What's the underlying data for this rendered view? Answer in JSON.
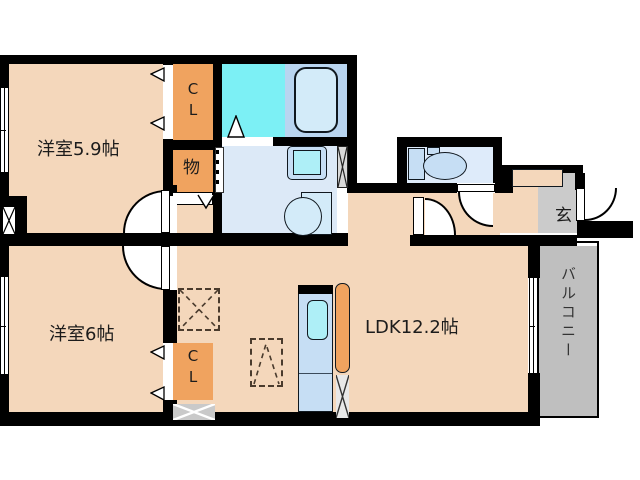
{
  "plan": {
    "title": "apartment floor plan",
    "rooms": {
      "bedroom1": {
        "label": "洋室5.9帖"
      },
      "bedroom2": {
        "label": "洋室6帖"
      },
      "ldk": {
        "label": "LDK12.2帖"
      },
      "closet_top": {
        "label": "C\nL"
      },
      "closet_bottom": {
        "label": "C\nL"
      },
      "storage": {
        "label": "物"
      },
      "entrance": {
        "label": "玄"
      },
      "balcony": {
        "label": "バルコニー"
      }
    },
    "colors": {
      "wall": "#000000",
      "room": "#f4d7bb",
      "orange": "#f0a35f",
      "bathcyan": "#7cf0f5",
      "bathblue": "#b9d5f0",
      "tub": "#d3ebf9",
      "washroom": "#dce9f7",
      "toiletfloor": "#deebfa",
      "fixture": "#c6def4",
      "sink": "#aeeff7",
      "entgray": "#cbcbcb",
      "balgray": "#bfbfbf"
    }
  }
}
